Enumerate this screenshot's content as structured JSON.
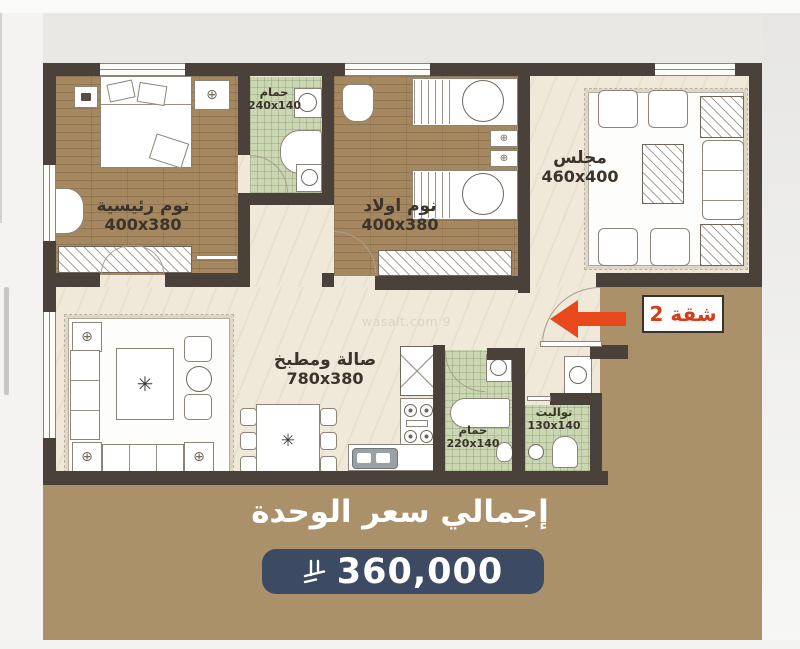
{
  "watermark": "wasalt.com 9",
  "tag": {
    "label": "شقة 2"
  },
  "rooms": {
    "master": {
      "name": "نوم رئيسية",
      "size": "400x380"
    },
    "kids": {
      "name": "نوم اولاد",
      "size": "400x380"
    },
    "majlis": {
      "name": "مجلس",
      "size": "460x400"
    },
    "hall": {
      "name": "صالة ومطبخ",
      "size": "780x380"
    },
    "bath_top": {
      "name": "حمام",
      "size": "240x140"
    },
    "bath_bottom": {
      "name": "حمام",
      "size": "220x140"
    },
    "toilet": {
      "name": "تواليت",
      "size": "130x140"
    }
  },
  "price": {
    "title": "إجمالي سعر الوحدة",
    "amount": "360,000",
    "currency_icon": "saudi-riyal-symbol"
  },
  "icons": {
    "fan": "⊕",
    "plant": "✳"
  },
  "colors": {
    "background_tan": "#ab9169",
    "price_badge_navy": "#3d4a63",
    "wall_dark": "#4a413a",
    "arrow_orange": "#e8491c",
    "tag_red": "#d63c18"
  }
}
